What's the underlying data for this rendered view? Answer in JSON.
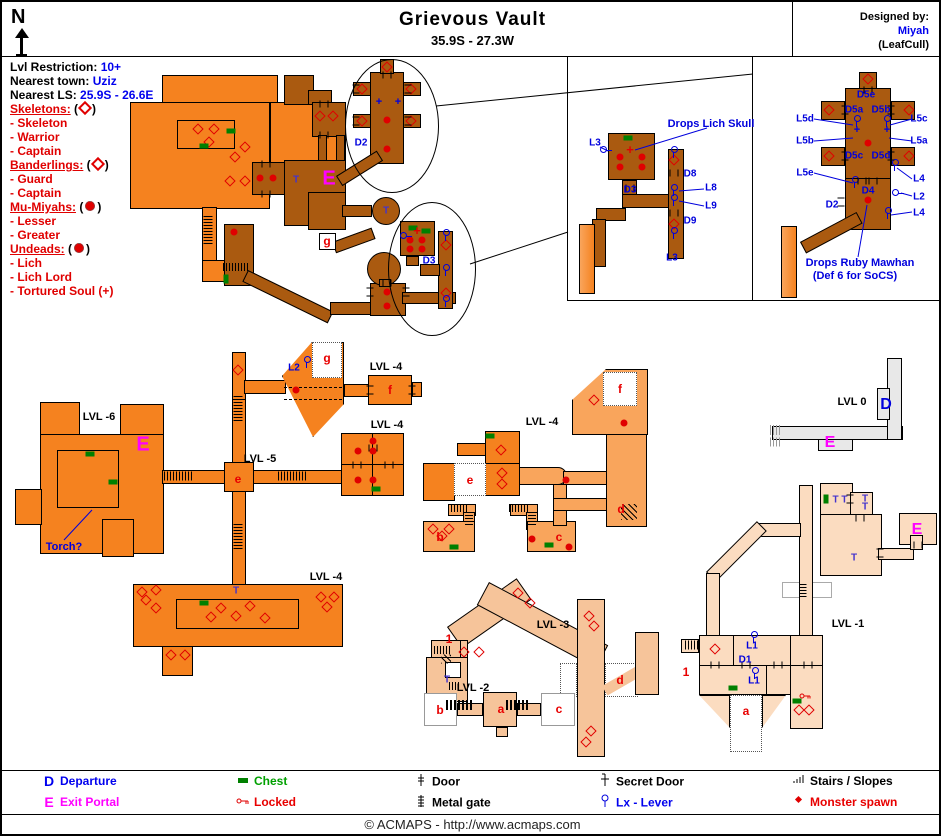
{
  "header": {
    "compass": "N",
    "title": "Grievous Vault",
    "coords": "35.9S - 27.3W",
    "designed_by_label": "Designed by:",
    "designer": "Miyah",
    "patch": "(LeafCull)"
  },
  "info": {
    "lvl_restriction_label": "Lvl Restriction:",
    "lvl_restriction": "10+",
    "nearest_town_label": "Nearest town:",
    "nearest_town": "Uziz",
    "nearest_ls_label": "Nearest LS:",
    "nearest_ls": "25.9S - 26.6E"
  },
  "monsters": [
    {
      "group": "Skeletons:",
      "symbol": "diamond",
      "members": [
        "- Skeleton",
        "- Warrior",
        "- Captain"
      ]
    },
    {
      "group": "Banderlings:",
      "symbol": "diamond",
      "members": [
        "- Guard",
        "- Captain"
      ]
    },
    {
      "group": "Mu-Miyahs:",
      "symbol": "dot",
      "members": [
        "- Lesser",
        "- Greater"
      ]
    },
    {
      "group": "Undeads:",
      "symbol": "dot",
      "members": [
        "- Lich",
        "- Lich Lord",
        "- Tortured Soul (+)"
      ]
    }
  ],
  "colors": {
    "upper_level_orange": "#F5821F",
    "lower_level_brown": "#AA5A10",
    "mid_peach": "#F9A55C",
    "lvl3_peach": "#F6C49A",
    "lvl1_peach": "#FBDCC0",
    "lvl0_gray": "#E8E8E8",
    "label_blue": "#0000DD",
    "monster_red": "#E00000",
    "chest_green": "#008000",
    "portal_magenta": "#FF00FF"
  },
  "map_labels": [
    {
      "t": "D2",
      "x": 359,
      "y": 141,
      "c": "b"
    },
    {
      "t": "T",
      "x": 294,
      "y": 178,
      "c": "t"
    },
    {
      "t": "E",
      "x": 327,
      "y": 177,
      "c": "m"
    },
    {
      "t": "g",
      "x": 325,
      "y": 239,
      "c": "r"
    },
    {
      "t": "T",
      "x": 384,
      "y": 209,
      "c": "t"
    },
    {
      "t": "D3",
      "x": 427,
      "y": 259,
      "c": "b"
    },
    {
      "t": "L3",
      "x": 593,
      "y": 141,
      "c": "b"
    },
    {
      "t": "Drops Lich Skull",
      "x": 709,
      "y": 122,
      "c": "a"
    },
    {
      "t": "D3",
      "x": 628,
      "y": 188,
      "c": "b"
    },
    {
      "t": "D8",
      "x": 688,
      "y": 172,
      "c": "b"
    },
    {
      "t": "L8",
      "x": 709,
      "y": 186,
      "c": "b"
    },
    {
      "t": "L9",
      "x": 709,
      "y": 204,
      "c": "b"
    },
    {
      "t": "D9",
      "x": 688,
      "y": 219,
      "c": "b"
    },
    {
      "t": "L3",
      "x": 670,
      "y": 256,
      "c": "b"
    },
    {
      "t": "D5e",
      "x": 864,
      "y": 93,
      "c": "b"
    },
    {
      "t": "D5a",
      "x": 852,
      "y": 108,
      "c": "b"
    },
    {
      "t": "D5b",
      "x": 879,
      "y": 108,
      "c": "b"
    },
    {
      "t": "L5d",
      "x": 803,
      "y": 117,
      "c": "b"
    },
    {
      "t": "L5c",
      "x": 917,
      "y": 117,
      "c": "b"
    },
    {
      "t": "L5b",
      "x": 803,
      "y": 139,
      "c": "b"
    },
    {
      "t": "L5a",
      "x": 917,
      "y": 139,
      "c": "b"
    },
    {
      "t": "D5c",
      "x": 852,
      "y": 154,
      "c": "b"
    },
    {
      "t": "D5d",
      "x": 879,
      "y": 154,
      "c": "b"
    },
    {
      "t": "L5e",
      "x": 803,
      "y": 171,
      "c": "b"
    },
    {
      "t": "D4",
      "x": 866,
      "y": 189,
      "c": "b"
    },
    {
      "t": "L4",
      "x": 917,
      "y": 177,
      "c": "b"
    },
    {
      "t": "L2",
      "x": 917,
      "y": 195,
      "c": "b"
    },
    {
      "t": "D2",
      "x": 830,
      "y": 203,
      "c": "b"
    },
    {
      "t": "L4",
      "x": 917,
      "y": 211,
      "c": "b"
    },
    {
      "t": "Drops Ruby Mawhan",
      "x": 858,
      "y": 261,
      "c": "a"
    },
    {
      "t": "(Def 6 for SoCS)",
      "x": 853,
      "y": 274,
      "c": "a"
    },
    {
      "t": "LVL -6",
      "x": 97,
      "y": 415,
      "c": "lv"
    },
    {
      "t": "E",
      "x": 141,
      "y": 443,
      "c": "m"
    },
    {
      "t": "Torch?",
      "x": 62,
      "y": 545,
      "c": "a"
    },
    {
      "t": "LVL -5",
      "x": 258,
      "y": 457,
      "c": "lv"
    },
    {
      "t": "e",
      "x": 236,
      "y": 477,
      "c": "r"
    },
    {
      "t": "L2",
      "x": 292,
      "y": 366,
      "c": "b"
    },
    {
      "t": "g",
      "x": 325,
      "y": 356,
      "c": "r"
    },
    {
      "t": "LVL -4",
      "x": 384,
      "y": 365,
      "c": "lv"
    },
    {
      "t": "f",
      "x": 388,
      "y": 388,
      "c": "r"
    },
    {
      "t": "LVL -4",
      "x": 385,
      "y": 423,
      "c": "lv"
    },
    {
      "t": "LVL -4",
      "x": 540,
      "y": 420,
      "c": "lv"
    },
    {
      "t": "e",
      "x": 468,
      "y": 478,
      "c": "r"
    },
    {
      "t": "f",
      "x": 618,
      "y": 387,
      "c": "r"
    },
    {
      "t": "b",
      "x": 438,
      "y": 535,
      "c": "r"
    },
    {
      "t": "c",
      "x": 557,
      "y": 535,
      "c": "r"
    },
    {
      "t": "d",
      "x": 619,
      "y": 507,
      "c": "r"
    },
    {
      "t": "LVL 0",
      "x": 850,
      "y": 400,
      "c": "lv"
    },
    {
      "t": "D",
      "x": 884,
      "y": 403,
      "c": "bb"
    },
    {
      "t": "E",
      "x": 828,
      "y": 441,
      "c": "m2"
    },
    {
      "t": "LVL -4",
      "x": 324,
      "y": 575,
      "c": "lv"
    },
    {
      "t": "T",
      "x": 234,
      "y": 589,
      "c": "t"
    },
    {
      "t": "LVL -3",
      "x": 551,
      "y": 623,
      "c": "lv"
    },
    {
      "t": "1",
      "x": 447,
      "y": 637,
      "c": "rs"
    },
    {
      "t": "T",
      "x": 445,
      "y": 678,
      "c": "t"
    },
    {
      "t": "LVL -2",
      "x": 471,
      "y": 686,
      "c": "lv"
    },
    {
      "t": "b",
      "x": 438,
      "y": 708,
      "c": "r"
    },
    {
      "t": "a",
      "x": 499,
      "y": 707,
      "c": "r"
    },
    {
      "t": "c",
      "x": 557,
      "y": 707,
      "c": "r"
    },
    {
      "t": "d",
      "x": 618,
      "y": 678,
      "c": "r"
    },
    {
      "t": "LVL -1",
      "x": 846,
      "y": 622,
      "c": "lv"
    },
    {
      "t": "1",
      "x": 684,
      "y": 670,
      "c": "rs"
    },
    {
      "t": "L1",
      "x": 750,
      "y": 644,
      "c": "b"
    },
    {
      "t": "D1",
      "x": 743,
      "y": 658,
      "c": "b"
    },
    {
      "t": "L1",
      "x": 752,
      "y": 679,
      "c": "b"
    },
    {
      "t": "T T",
      "x": 838,
      "y": 498,
      "c": "t"
    },
    {
      "t": "T",
      "x": 863,
      "y": 497,
      "c": "t"
    },
    {
      "t": "T",
      "x": 863,
      "y": 505,
      "c": "t"
    },
    {
      "t": "T",
      "x": 852,
      "y": 556,
      "c": "t"
    },
    {
      "t": "E",
      "x": 915,
      "y": 528,
      "c": "m2"
    },
    {
      "t": "a",
      "x": 744,
      "y": 709,
      "c": "r"
    }
  ],
  "markers": [
    {
      "t": "sd",
      "x": 196,
      "y": 127
    },
    {
      "t": "sd",
      "x": 212,
      "y": 127
    },
    {
      "t": "sd",
      "x": 207,
      "y": 140
    },
    {
      "t": "sd",
      "x": 243,
      "y": 145
    },
    {
      "t": "sd",
      "x": 233,
      "y": 155
    },
    {
      "t": "sd",
      "x": 228,
      "y": 179
    },
    {
      "t": "sd",
      "x": 243,
      "y": 179
    },
    {
      "t": "sd",
      "x": 318,
      "y": 114
    },
    {
      "t": "sd",
      "x": 331,
      "y": 114
    },
    {
      "t": "sd",
      "x": 385,
      "y": 65
    },
    {
      "t": "sd",
      "x": 360,
      "y": 87
    },
    {
      "t": "sd",
      "x": 409,
      "y": 87
    },
    {
      "t": "sd",
      "x": 360,
      "y": 119
    },
    {
      "t": "sd",
      "x": 409,
      "y": 119
    },
    {
      "t": "sd",
      "x": 444,
      "y": 243
    },
    {
      "t": "sd",
      "x": 444,
      "y": 291
    },
    {
      "t": "sd",
      "x": 236,
      "y": 368
    },
    {
      "t": "sd",
      "x": 499,
      "y": 448
    },
    {
      "t": "sd",
      "x": 500,
      "y": 471
    },
    {
      "t": "sd",
      "x": 500,
      "y": 482
    },
    {
      "t": "sd",
      "x": 592,
      "y": 398
    },
    {
      "t": "sd",
      "x": 431,
      "y": 527
    },
    {
      "t": "sd",
      "x": 447,
      "y": 527
    },
    {
      "t": "sd",
      "x": 440,
      "y": 534
    },
    {
      "t": "sd",
      "x": 140,
      "y": 590
    },
    {
      "t": "sd",
      "x": 154,
      "y": 588
    },
    {
      "t": "sd",
      "x": 144,
      "y": 598
    },
    {
      "t": "sd",
      "x": 154,
      "y": 606
    },
    {
      "t": "sd",
      "x": 219,
      "y": 606
    },
    {
      "t": "sd",
      "x": 248,
      "y": 604
    },
    {
      "t": "sd",
      "x": 209,
      "y": 615
    },
    {
      "t": "sd",
      "x": 234,
      "y": 614
    },
    {
      "t": "sd",
      "x": 263,
      "y": 616
    },
    {
      "t": "sd",
      "x": 319,
      "y": 595
    },
    {
      "t": "sd",
      "x": 332,
      "y": 595
    },
    {
      "t": "sd",
      "x": 325,
      "y": 605
    },
    {
      "t": "sd",
      "x": 169,
      "y": 653
    },
    {
      "t": "sd",
      "x": 183,
      "y": 653
    },
    {
      "t": "sd",
      "x": 516,
      "y": 591
    },
    {
      "t": "sd",
      "x": 528,
      "y": 601
    },
    {
      "t": "sd",
      "x": 462,
      "y": 650
    },
    {
      "t": "sd",
      "x": 477,
      "y": 650
    },
    {
      "t": "sd",
      "x": 587,
      "y": 614
    },
    {
      "t": "sd",
      "x": 592,
      "y": 624
    },
    {
      "t": "sd",
      "x": 589,
      "y": 729
    },
    {
      "t": "sd",
      "x": 584,
      "y": 740
    },
    {
      "t": "sd",
      "x": 713,
      "y": 647
    },
    {
      "t": "sd",
      "x": 797,
      "y": 708
    },
    {
      "t": "sd",
      "x": 807,
      "y": 708
    },
    {
      "t": "sd",
      "x": 672,
      "y": 158
    },
    {
      "t": "sd",
      "x": 672,
      "y": 222
    },
    {
      "t": "sd",
      "x": 866,
      "y": 77
    },
    {
      "t": "sd",
      "x": 827,
      "y": 108
    },
    {
      "t": "sd",
      "x": 907,
      "y": 108
    },
    {
      "t": "sd",
      "x": 827,
      "y": 154
    },
    {
      "t": "sd",
      "x": 907,
      "y": 154
    },
    {
      "t": "ms",
      "x": 258,
      "y": 176
    },
    {
      "t": "ms",
      "x": 271,
      "y": 176
    },
    {
      "t": "ms",
      "x": 385,
      "y": 118
    },
    {
      "t": "ms",
      "x": 385,
      "y": 147
    },
    {
      "t": "ms",
      "x": 232,
      "y": 230
    },
    {
      "t": "ms",
      "x": 385,
      "y": 290
    },
    {
      "t": "ms",
      "x": 385,
      "y": 304
    },
    {
      "t": "ms",
      "x": 408,
      "y": 238
    },
    {
      "t": "ms",
      "x": 420,
      "y": 238
    },
    {
      "t": "ms",
      "x": 408,
      "y": 247
    },
    {
      "t": "ms",
      "x": 420,
      "y": 247
    },
    {
      "t": "ms",
      "x": 618,
      "y": 155
    },
    {
      "t": "ms",
      "x": 640,
      "y": 155
    },
    {
      "t": "ms",
      "x": 618,
      "y": 165
    },
    {
      "t": "ms",
      "x": 640,
      "y": 165
    },
    {
      "t": "ms",
      "x": 866,
      "y": 141
    },
    {
      "t": "ms",
      "x": 866,
      "y": 198
    },
    {
      "t": "ms",
      "x": 294,
      "y": 388
    },
    {
      "t": "ms",
      "x": 356,
      "y": 449
    },
    {
      "t": "ms",
      "x": 371,
      "y": 439
    },
    {
      "t": "ms",
      "x": 371,
      "y": 449
    },
    {
      "t": "ms",
      "x": 356,
      "y": 478
    },
    {
      "t": "ms",
      "x": 371,
      "y": 478
    },
    {
      "t": "ms",
      "x": 564,
      "y": 478
    },
    {
      "t": "ms",
      "x": 622,
      "y": 421
    },
    {
      "t": "ms",
      "x": 530,
      "y": 537
    },
    {
      "t": "ms",
      "x": 567,
      "y": 545
    },
    {
      "t": "ch",
      "x": 229,
      "y": 129
    },
    {
      "t": "ch",
      "x": 202,
      "y": 144
    },
    {
      "t": "ch",
      "x": 411,
      "y": 226
    },
    {
      "t": "ch",
      "x": 424,
      "y": 229
    },
    {
      "t": "ch",
      "x": 626,
      "y": 136
    },
    {
      "t": "ch",
      "x": 88,
      "y": 452
    },
    {
      "t": "ch",
      "x": 111,
      "y": 480
    },
    {
      "t": "ch",
      "x": 488,
      "y": 434
    },
    {
      "t": "ch",
      "x": 374,
      "y": 487
    },
    {
      "t": "ch",
      "x": 452,
      "y": 545
    },
    {
      "t": "ch",
      "x": 547,
      "y": 543
    },
    {
      "t": "ch",
      "x": 202,
      "y": 601
    },
    {
      "t": "ch",
      "x": 731,
      "y": 686
    },
    {
      "t": "ch",
      "x": 795,
      "y": 699
    },
    {
      "t": "cv",
      "x": 224,
      "y": 277
    },
    {
      "t": "cv",
      "x": 824,
      "y": 497
    },
    {
      "t": "ts",
      "x": 628,
      "y": 148
    },
    {
      "t": "ts",
      "x": 415,
      "y": 229
    },
    {
      "t": "bx",
      "x": 377,
      "y": 100
    },
    {
      "t": "bx",
      "x": 396,
      "y": 100
    },
    {
      "t": "bx",
      "x": 855,
      "y": 128
    },
    {
      "t": "bx",
      "x": 885,
      "y": 128
    },
    {
      "t": "lv",
      "x": 604,
      "y": 148,
      "r": -90
    },
    {
      "t": "lv",
      "x": 672,
      "y": 150
    },
    {
      "t": "lv",
      "x": 672,
      "y": 188
    },
    {
      "t": "lv",
      "x": 672,
      "y": 198
    },
    {
      "t": "lv",
      "x": 672,
      "y": 231
    },
    {
      "t": "lv",
      "x": 855,
      "y": 119
    },
    {
      "t": "lv",
      "x": 885,
      "y": 119
    },
    {
      "t": "lv",
      "x": 893,
      "y": 163
    },
    {
      "t": "lv",
      "x": 886,
      "y": 211
    },
    {
      "t": "lv",
      "x": 853,
      "y": 180
    },
    {
      "t": "lv",
      "x": 404,
      "y": 234,
      "r": -90
    },
    {
      "t": "lv",
      "x": 444,
      "y": 233
    },
    {
      "t": "lv",
      "x": 444,
      "y": 268
    },
    {
      "t": "lv",
      "x": 444,
      "y": 299
    },
    {
      "t": "lv",
      "x": 305,
      "y": 360
    },
    {
      "t": "lv",
      "x": 752,
      "y": 635
    },
    {
      "t": "lv",
      "x": 753,
      "y": 671
    },
    {
      "t": "lv",
      "x": 896,
      "y": 191,
      "r": -90
    },
    {
      "t": "dk",
      "x": 264,
      "y": 162
    },
    {
      "t": "dk",
      "x": 264,
      "y": 192
    },
    {
      "t": "dk",
      "x": 322,
      "y": 102
    },
    {
      "t": "dk",
      "x": 322,
      "y": 133
    },
    {
      "t": "dk",
      "x": 385,
      "y": 73
    },
    {
      "t": "dk",
      "x": 354,
      "y": 87,
      "r": 90
    },
    {
      "t": "dk",
      "x": 406,
      "y": 87,
      "r": 90
    },
    {
      "t": "dk",
      "x": 354,
      "y": 119,
      "r": 90
    },
    {
      "t": "dk",
      "x": 406,
      "y": 119,
      "r": 90
    },
    {
      "t": "dk",
      "x": 672,
      "y": 171
    },
    {
      "t": "dk",
      "x": 672,
      "y": 211
    },
    {
      "t": "dk",
      "x": 628,
      "y": 186
    },
    {
      "t": "dk",
      "x": 866,
      "y": 88
    },
    {
      "t": "dk",
      "x": 843,
      "y": 108,
      "r": 90
    },
    {
      "t": "dk",
      "x": 889,
      "y": 108,
      "r": 90
    },
    {
      "t": "dk",
      "x": 843,
      "y": 154,
      "r": 90
    },
    {
      "t": "dk",
      "x": 889,
      "y": 154,
      "r": 90
    },
    {
      "t": "dk",
      "x": 860,
      "y": 179
    },
    {
      "t": "dk",
      "x": 871,
      "y": 179
    },
    {
      "t": "dk",
      "x": 839,
      "y": 200,
      "r": 90
    },
    {
      "t": "dk",
      "x": 371,
      "y": 446
    },
    {
      "t": "dk",
      "x": 355,
      "y": 463
    },
    {
      "t": "dk",
      "x": 387,
      "y": 463
    },
    {
      "t": "dk",
      "x": 368,
      "y": 388,
      "r": 90
    },
    {
      "t": "dk",
      "x": 410,
      "y": 388,
      "r": 90
    },
    {
      "t": "dk",
      "x": 713,
      "y": 663
    },
    {
      "t": "dk",
      "x": 744,
      "y": 663
    },
    {
      "t": "dk",
      "x": 776,
      "y": 663
    },
    {
      "t": "dk",
      "x": 806,
      "y": 663
    },
    {
      "t": "dk",
      "x": 878,
      "y": 551,
      "r": 90
    },
    {
      "t": "dk",
      "x": 916,
      "y": 543
    },
    {
      "t": "dk",
      "x": 848,
      "y": 497,
      "r": 90
    },
    {
      "t": "dk",
      "x": 858,
      "y": 516
    },
    {
      "t": "dk",
      "x": 368,
      "y": 290,
      "r": 90
    },
    {
      "t": "dk",
      "x": 404,
      "y": 290,
      "r": 90
    },
    {
      "t": "dk",
      "x": 385,
      "y": 281
    },
    {
      "t": "sh",
      "x": 176,
      "y": 474,
      "w": 28,
      "h": 9
    },
    {
      "t": "sh",
      "x": 290,
      "y": 474,
      "w": 28,
      "h": 9
    },
    {
      "t": "sh",
      "x": 456,
      "y": 506,
      "w": 20,
      "h": 8
    },
    {
      "t": "sh",
      "x": 517,
      "y": 506,
      "w": 20,
      "h": 8
    },
    {
      "t": "sh",
      "x": 234,
      "y": 265,
      "w": 26,
      "h": 8
    },
    {
      "t": "sh",
      "x": 690,
      "y": 643,
      "w": 14,
      "h": 9
    },
    {
      "t": "sh",
      "x": 440,
      "y": 648,
      "w": 16,
      "h": 8
    },
    {
      "t": "sh",
      "x": 453,
      "y": 684,
      "w": 12,
      "h": 8
    },
    {
      "t": "sv",
      "x": 206,
      "y": 228,
      "w": 9,
      "h": 28
    },
    {
      "t": "sv",
      "x": 236,
      "y": 406,
      "w": 9,
      "h": 26
    },
    {
      "t": "sv",
      "x": 236,
      "y": 534,
      "w": 9,
      "h": 26
    },
    {
      "t": "sv",
      "x": 467,
      "y": 516,
      "w": 8,
      "h": 14
    },
    {
      "t": "sv",
      "x": 530,
      "y": 516,
      "w": 8,
      "h": 14
    },
    {
      "t": "sv",
      "x": 801,
      "y": 588,
      "w": 7,
      "h": 14
    },
    {
      "t": "gh",
      "x": 457,
      "y": 703,
      "w": 26,
      "h": 10
    },
    {
      "t": "gh",
      "x": 516,
      "y": 703,
      "w": 24,
      "h": 10
    },
    {
      "t": "sl",
      "x": 627,
      "y": 510,
      "w": 16,
      "h": 16
    },
    {
      "t": "sl",
      "x": 444,
      "y": 657,
      "w": 10,
      "h": 9
    },
    {
      "t": "hg",
      "x": 774,
      "y": 428,
      "w": 12,
      "h": 10
    },
    {
      "t": "hg",
      "x": 774,
      "y": 440,
      "w": 12,
      "h": 9
    },
    {
      "t": "key",
      "x": 803,
      "y": 688
    }
  ],
  "legend": [
    {
      "symbol": "D",
      "label": "Departure"
    },
    {
      "symbol": "E",
      "label": "Exit Portal"
    },
    {
      "icon": "chest-icon",
      "label": "Chest"
    },
    {
      "icon": "locked-icon",
      "label": "Locked"
    },
    {
      "icon": "door-icon",
      "label": "Door"
    },
    {
      "icon": "metal-gate-icon",
      "label": "Metal gate"
    },
    {
      "icon": "secret-door-icon",
      "label": "Secret Door"
    },
    {
      "icon": "lever-icon",
      "label": "Lx - Lever"
    },
    {
      "icon": "stairs-icon",
      "label": "Stairs / Slopes"
    },
    {
      "icon": "monster-spawn-icon",
      "label": "Monster spawn"
    }
  ],
  "footer": "© ACMAPS - http://www.acmaps.com"
}
